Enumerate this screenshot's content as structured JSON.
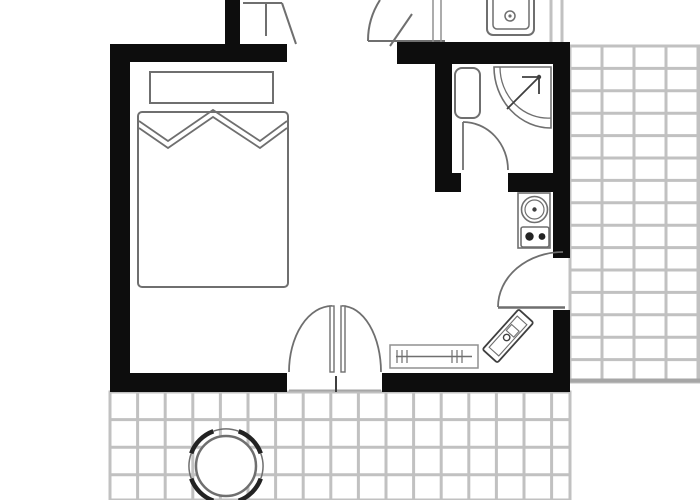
{
  "meta": {
    "title": "Studio apartment floor plan with bed, bathroom, kitchenette and tiled terraces"
  },
  "canvas": {
    "w": 700,
    "h": 500
  },
  "palette": {
    "wall": "#0d0d0d",
    "line": "#6f6f6f",
    "lineDark": "#3f3f3f",
    "lineLight": "#909090",
    "tile": "#c1c1c1",
    "tileEdge": "#a6a6a6",
    "chair": "#232323",
    "white": "#ffffff"
  },
  "elements": [
    {
      "name": "terrace-right-tiles",
      "type": "tiles",
      "x": 570,
      "y": 46,
      "w": 130,
      "h": 336,
      "tw": 32,
      "th": 22.4,
      "stroke": "tile",
      "sw": 3
    },
    {
      "name": "terrace-right-bottom-edge",
      "type": "line",
      "x1": 570,
      "y1": 380.5,
      "x2": 700,
      "y2": 380.5,
      "stroke": "tileEdge",
      "sw": 4
    },
    {
      "name": "terrace-bottom-tiles",
      "type": "tiles",
      "x": 110,
      "y": 392,
      "w": 460,
      "h": 108,
      "tw": 27.6,
      "th": 27.6,
      "stroke": "tile",
      "sw": 3
    },
    {
      "name": "patio-chair-arc-se",
      "type": "arc",
      "cx": 226,
      "cy": 466,
      "r": 37,
      "a0": 20,
      "a1": 70,
      "stroke": "chair",
      "sw": 4.5
    },
    {
      "name": "patio-chair-arc-sw",
      "type": "arc",
      "cx": 226,
      "cy": 466,
      "r": 37,
      "a0": 110,
      "a1": 160,
      "stroke": "chair",
      "sw": 4.5
    },
    {
      "name": "patio-chair-arc-nw",
      "type": "arc",
      "cx": 226,
      "cy": 466,
      "r": 37,
      "a0": 200,
      "a1": 250,
      "stroke": "chair",
      "sw": 4.5
    },
    {
      "name": "patio-chair-arc-ne",
      "type": "arc",
      "cx": 226,
      "cy": 466,
      "r": 37,
      "a0": 290,
      "a1": 340,
      "stroke": "chair",
      "sw": 4.5
    },
    {
      "name": "patio-chair-thin-arc-e",
      "type": "arc",
      "cx": 226,
      "cy": 466,
      "r": 37,
      "a0": -20,
      "a1": 20,
      "stroke": "line",
      "sw": 1.5
    },
    {
      "name": "patio-chair-thin-arc-s",
      "type": "arc",
      "cx": 226,
      "cy": 466,
      "r": 37,
      "a0": 70,
      "a1": 110,
      "stroke": "line",
      "sw": 1.5
    },
    {
      "name": "patio-chair-thin-arc-w",
      "type": "arc",
      "cx": 226,
      "cy": 466,
      "r": 37,
      "a0": 160,
      "a1": 200,
      "stroke": "line",
      "sw": 1.5
    },
    {
      "name": "patio-chair-thin-arc-n",
      "type": "arc",
      "cx": 226,
      "cy": 466,
      "r": 37,
      "a0": 250,
      "a1": 290,
      "stroke": "line",
      "sw": 1.5
    },
    {
      "name": "patio-round-table",
      "type": "circle",
      "cx": 226,
      "cy": 466,
      "r": 30,
      "fill": "white",
      "stroke": "line",
      "sw": 2.5
    },
    {
      "name": "upper-hall-frame-line-h",
      "type": "line",
      "x1": 243,
      "y1": 3,
      "x2": 282,
      "y2": 3,
      "stroke": "line",
      "sw": 2
    },
    {
      "name": "upper-hall-frame-line-v",
      "type": "line",
      "x1": 266,
      "y1": 3,
      "x2": 266,
      "y2": 36,
      "stroke": "line",
      "sw": 2
    },
    {
      "name": "upper-hall-door-leaf-diagonal",
      "type": "line",
      "x1": 282,
      "y1": 3,
      "x2": 296,
      "y2": 44,
      "stroke": "line",
      "sw": 2
    },
    {
      "name": "upper-hall-door-arc",
      "type": "path",
      "d": "M368,41 A75,75 0 0 1 380,0",
      "stroke": "line",
      "sw": 2,
      "fill": "none"
    },
    {
      "name": "upper-hall-threshold-line",
      "type": "line",
      "x1": 368,
      "y1": 41,
      "x2": 445,
      "y2": 41,
      "stroke": "line",
      "sw": 2
    },
    {
      "name": "upper-hall-door-leaf-2",
      "type": "line",
      "x1": 390,
      "y1": 46,
      "x2": 412,
      "y2": 14,
      "stroke": "line",
      "sw": 2
    },
    {
      "name": "upper-hall-jamb-line-1",
      "type": "line",
      "x1": 433,
      "y1": 0,
      "x2": 433,
      "y2": 44,
      "stroke": "lineLight",
      "sw": 1.5
    },
    {
      "name": "upper-hall-jamb-line-2",
      "type": "line",
      "x1": 441,
      "y1": 0,
      "x2": 441,
      "y2": 44,
      "stroke": "lineLight",
      "sw": 1.5
    },
    {
      "name": "upper-wall-line-1",
      "type": "line",
      "x1": 551,
      "y1": 0,
      "x2": 551,
      "y2": 42,
      "stroke": "tile",
      "sw": 3
    },
    {
      "name": "upper-wall-line-2",
      "type": "line",
      "x1": 562,
      "y1": 0,
      "x2": 562,
      "y2": 42,
      "stroke": "tile",
      "sw": 3
    },
    {
      "name": "upper-kitchen-sink-outer",
      "type": "rect",
      "x": 487,
      "y": -8,
      "w": 47,
      "h": 43,
      "rx": 6,
      "stroke": "line",
      "sw": 2,
      "fill": "white"
    },
    {
      "name": "upper-kitchen-sink-basin",
      "type": "rect",
      "x": 493,
      "y": -4,
      "w": 36,
      "h": 33,
      "rx": 4,
      "stroke": "line",
      "sw": 1.5,
      "fill": "none"
    },
    {
      "name": "upper-kitchen-sink-drain",
      "type": "circle",
      "cx": 510,
      "cy": 16,
      "r": 5,
      "stroke": "line",
      "sw": 1.5,
      "fill": "white"
    },
    {
      "name": "upper-kitchen-sink-drain-dot",
      "type": "circle",
      "cx": 510,
      "cy": 16,
      "r": 1.6,
      "fill": "line"
    },
    {
      "name": "wall-left",
      "type": "rect",
      "x": 110,
      "y": 44,
      "w": 20,
      "h": 348,
      "fill": "wall"
    },
    {
      "name": "wall-top-left",
      "type": "rect",
      "x": 110,
      "y": 44,
      "w": 177,
      "h": 18,
      "fill": "wall"
    },
    {
      "name": "wall-upper-stub",
      "type": "rect",
      "x": 225,
      "y": 0,
      "w": 15,
      "h": 44,
      "fill": "wall"
    },
    {
      "name": "wall-top-right",
      "type": "rect",
      "x": 397,
      "y": 42,
      "w": 173,
      "h": 22,
      "fill": "wall"
    },
    {
      "name": "wall-bathroom-left",
      "type": "rect",
      "x": 435,
      "y": 64,
      "w": 17,
      "h": 110,
      "fill": "wall"
    },
    {
      "name": "wall-bathroom-bottom-stub",
      "type": "rect",
      "x": 435,
      "y": 173,
      "w": 26,
      "h": 19,
      "fill": "wall"
    },
    {
      "name": "wall-bathroom-bottom",
      "type": "rect",
      "x": 508,
      "y": 173,
      "w": 62,
      "h": 19,
      "fill": "wall"
    },
    {
      "name": "wall-right-upper",
      "type": "rect",
      "x": 553,
      "y": 64,
      "w": 17,
      "h": 194,
      "fill": "wall"
    },
    {
      "name": "wall-right-lower",
      "type": "rect",
      "x": 553,
      "y": 310,
      "w": 17,
      "h": 82,
      "fill": "wall"
    },
    {
      "name": "wall-bottom-left",
      "type": "rect",
      "x": 110,
      "y": 373,
      "w": 177,
      "h": 19,
      "fill": "wall"
    },
    {
      "name": "wall-bottom-right",
      "type": "rect",
      "x": 382,
      "y": 373,
      "w": 188,
      "h": 19,
      "fill": "wall"
    },
    {
      "name": "bed-headboard-shelf",
      "type": "rect",
      "x": 150,
      "y": 72,
      "w": 123,
      "h": 31,
      "stroke": "line",
      "sw": 2,
      "fill": "white"
    },
    {
      "name": "bed",
      "type": "rect",
      "x": 138,
      "y": 112,
      "w": 150,
      "h": 175,
      "rx": 4,
      "stroke": "line",
      "sw": 2,
      "fill": "white"
    },
    {
      "name": "bed-pillows-line-upper",
      "type": "polyline",
      "points": "139,121 168,141 213,110 260,141 287,121",
      "stroke": "line",
      "sw": 1.8
    },
    {
      "name": "bed-pillows-line-lower",
      "type": "polyline",
      "points": "139,128 168,148 213,117 260,148 287,128",
      "stroke": "line",
      "sw": 1.8
    },
    {
      "name": "radiator",
      "type": "rect",
      "x": 390,
      "y": 345,
      "w": 88,
      "h": 23,
      "stroke": "lineLight",
      "sw": 1.5,
      "fill": "white"
    },
    {
      "name": "radiator-center-line",
      "type": "line",
      "x1": 396,
      "y1": 356.5,
      "x2": 472,
      "y2": 356.5,
      "stroke": "line",
      "sw": 1.5
    },
    {
      "name": "radiator-tick-l1",
      "type": "line",
      "x1": 397,
      "y1": 350,
      "x2": 397,
      "y2": 363,
      "stroke": "line",
      "sw": 1.2
    },
    {
      "name": "radiator-tick-l2",
      "type": "line",
      "x1": 402,
      "y1": 350,
      "x2": 402,
      "y2": 363,
      "stroke": "line",
      "sw": 1.2
    },
    {
      "name": "radiator-tick-l3",
      "type": "line",
      "x1": 407,
      "y1": 350,
      "x2": 407,
      "y2": 363,
      "stroke": "line",
      "sw": 1.2
    },
    {
      "name": "radiator-tick-r1",
      "type": "line",
      "x1": 452,
      "y1": 350,
      "x2": 452,
      "y2": 363,
      "stroke": "line",
      "sw": 1.2
    },
    {
      "name": "radiator-tick-r2",
      "type": "line",
      "x1": 457,
      "y1": 350,
      "x2": 457,
      "y2": 363,
      "stroke": "line",
      "sw": 1.2
    },
    {
      "name": "radiator-tick-r3",
      "type": "line",
      "x1": 462,
      "y1": 350,
      "x2": 462,
      "y2": 363,
      "stroke": "line",
      "sw": 1.2
    },
    {
      "name": "console-table-rotated",
      "type": "group",
      "transform": "rotate(-48 508 336)",
      "children": [
        {
          "name": "console-outer",
          "type": "rect",
          "x": 481,
          "y": 326,
          "w": 54,
          "h": 20,
          "rx": 2,
          "stroke": "lineDark",
          "sw": 1.8,
          "fill": "white"
        },
        {
          "name": "console-inner",
          "type": "rect",
          "x": 487,
          "y": 329.5,
          "w": 42,
          "h": 13,
          "stroke": "line",
          "sw": 1.1,
          "fill": "none"
        },
        {
          "name": "console-knob",
          "type": "circle",
          "cx": 506,
          "cy": 336,
          "r": 3.2,
          "stroke": "lineDark",
          "sw": 1.4,
          "fill": "white"
        },
        {
          "name": "console-tray",
          "type": "rect",
          "x": 511,
          "y": 331,
          "w": 8,
          "h": 10,
          "stroke": "line",
          "sw": 1.1,
          "fill": "none"
        }
      ]
    },
    {
      "name": "toilet",
      "type": "rect",
      "x": 455,
      "y": 68,
      "w": 25,
      "h": 50,
      "rx": 7,
      "stroke": "line",
      "sw": 2,
      "fill": "white"
    },
    {
      "name": "shower-tray",
      "type": "path",
      "d": "M494,67 L551,67 L551,128 A57,61 0 0 1 494,67 Z",
      "stroke": "line",
      "sw": 1.6,
      "fill": "white"
    },
    {
      "name": "shower-tray-inner-arc",
      "type": "path",
      "d": "M551,118 A48,51 0 0 1 500,67",
      "stroke": "line",
      "sw": 1.3,
      "fill": "none"
    },
    {
      "name": "shower-arrow-shaft",
      "type": "line",
      "x1": 507,
      "y1": 109,
      "x2": 539,
      "y2": 77,
      "stroke": "lineDark",
      "sw": 1.8
    },
    {
      "name": "shower-arrow-head-h",
      "type": "line",
      "x1": 522,
      "y1": 77,
      "x2": 539,
      "y2": 77,
      "stroke": "lineDark",
      "sw": 1.8
    },
    {
      "name": "shower-arrow-head-v",
      "type": "line",
      "x1": 539,
      "y1": 77,
      "x2": 539,
      "y2": 94,
      "stroke": "lineDark",
      "sw": 1.8
    },
    {
      "name": "shower-arrow-dot",
      "type": "circle",
      "cx": 539,
      "cy": 77,
      "r": 2.2,
      "fill": "lineDark"
    },
    {
      "name": "bathroom-door-leaf",
      "type": "line",
      "x1": 463,
      "y1": 122,
      "x2": 463,
      "y2": 170,
      "stroke": "line",
      "sw": 1.8
    },
    {
      "name": "bathroom-door-arc",
      "type": "path",
      "d": "M463,122 A45,48 0 0 1 508,170",
      "stroke": "line",
      "sw": 1.8,
      "fill": "none"
    },
    {
      "name": "kitchenette-unit",
      "type": "rect",
      "x": 518,
      "y": 193,
      "w": 32,
      "h": 55,
      "stroke": "line",
      "sw": 1.6,
      "fill": "white"
    },
    {
      "name": "kitchenette-sink-outer",
      "type": "circle",
      "cx": 534.5,
      "cy": 209.5,
      "r": 13,
      "stroke": "line",
      "sw": 1.6,
      "fill": "white"
    },
    {
      "name": "kitchenette-sink-inner",
      "type": "circle",
      "cx": 534.5,
      "cy": 209.5,
      "r": 9.5,
      "stroke": "line",
      "sw": 1.2,
      "fill": "none"
    },
    {
      "name": "kitchenette-sink-drain",
      "type": "circle",
      "cx": 534.5,
      "cy": 209.5,
      "r": 2.2,
      "fill": "lineDark"
    },
    {
      "name": "kitchenette-stove",
      "type": "rect",
      "x": 521,
      "y": 227,
      "w": 28,
      "h": 20,
      "rx": 2,
      "stroke": "line",
      "sw": 1.6,
      "fill": "white"
    },
    {
      "name": "kitchenette-burner-left",
      "type": "circle",
      "cx": 529.5,
      "cy": 236.5,
      "r": 4.2,
      "fill": "chair"
    },
    {
      "name": "kitchenette-burner-right",
      "type": "circle",
      "cx": 542,
      "cy": 236.5,
      "r": 3.4,
      "fill": "chair"
    },
    {
      "name": "terrace-door-leaf",
      "type": "line",
      "x1": 498,
      "y1": 307.5,
      "x2": 565,
      "y2": 307.5,
      "stroke": "line",
      "sw": 2.5
    },
    {
      "name": "terrace-door-arc",
      "type": "path",
      "d": "M498,307 A65,55 0 0 1 563,252",
      "stroke": "line",
      "sw": 1.8,
      "fill": "none"
    },
    {
      "name": "balcony-door-arc-left",
      "type": "path",
      "d": "M289,372 A43,66 0 0 1 332,306",
      "stroke": "line",
      "sw": 1.8,
      "fill": "none"
    },
    {
      "name": "balcony-door-arc-right",
      "type": "path",
      "d": "M381,372 A39,66 0 0 0 342,306",
      "stroke": "line",
      "sw": 1.8,
      "fill": "none"
    },
    {
      "name": "balcony-door-leaf-left",
      "type": "rect",
      "x": 330,
      "y": 306,
      "w": 4,
      "h": 66,
      "stroke": "line",
      "sw": 1.4,
      "fill": "white"
    },
    {
      "name": "balcony-door-leaf-right",
      "type": "rect",
      "x": 341,
      "y": 306,
      "w": 4,
      "h": 66,
      "stroke": "line",
      "sw": 1.4,
      "fill": "white"
    },
    {
      "name": "balcony-door-threshold",
      "type": "line",
      "x1": 289,
      "y1": 390.5,
      "x2": 381,
      "y2": 390.5,
      "stroke": "tileEdge",
      "sw": 2
    },
    {
      "name": "balcony-door-center-post",
      "type": "line",
      "x1": 336,
      "y1": 376,
      "x2": 336,
      "y2": 392,
      "stroke": "lineDark",
      "sw": 2
    }
  ]
}
